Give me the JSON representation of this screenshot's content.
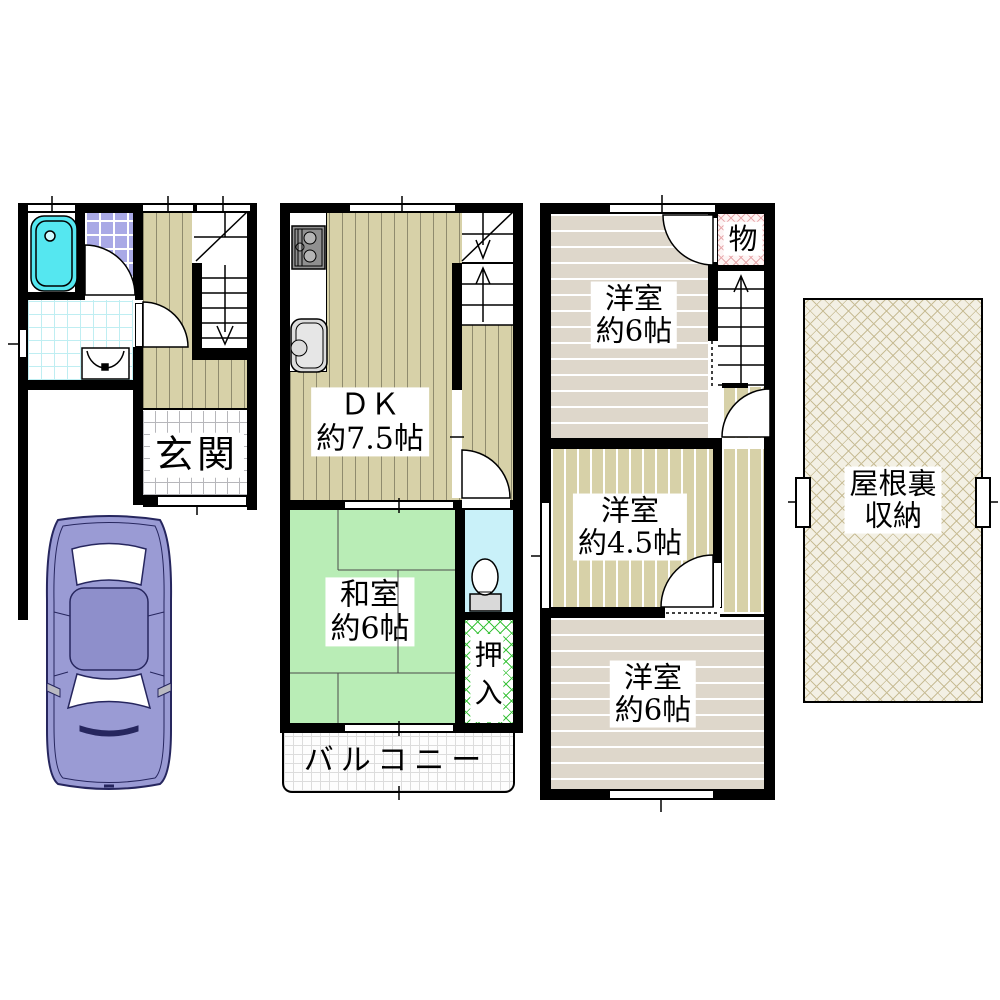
{
  "plans": {
    "floor1": {
      "entrance": "玄関"
    },
    "floor2": {
      "dk_name": "ＤＫ",
      "dk_size": "約7.5帖",
      "washitsu_name": "和室",
      "washitsu_size": "約6帖",
      "closet": "押入",
      "balcony": "バルコニー"
    },
    "floor3": {
      "north_room_name": "洋室",
      "north_room_size": "約6帖",
      "storage": "物",
      "mid_room_name": "洋室",
      "mid_room_size": "約4.5帖",
      "south_room_name": "洋室",
      "south_room_size": "約6帖"
    },
    "attic": {
      "name_line1": "屋根裏",
      "name_line2": "収納"
    }
  },
  "palette": {
    "wall": "#000000",
    "flooring_olive": "#d7d1a8",
    "flooring_beige": "#ded7cb",
    "tatami_green": "#b9edb6",
    "tile_purple": "#a9a9e6",
    "bathtub_cyan": "#55e7f0",
    "toilet_floor_blue": "#c9f1f9",
    "closet_hatch_green": "#3ec43e",
    "storage_hatch_pink": "#e8a9ac",
    "attic_hatch_tan": "#c8bd96",
    "car_body_purple": "#9a9bd4"
  }
}
